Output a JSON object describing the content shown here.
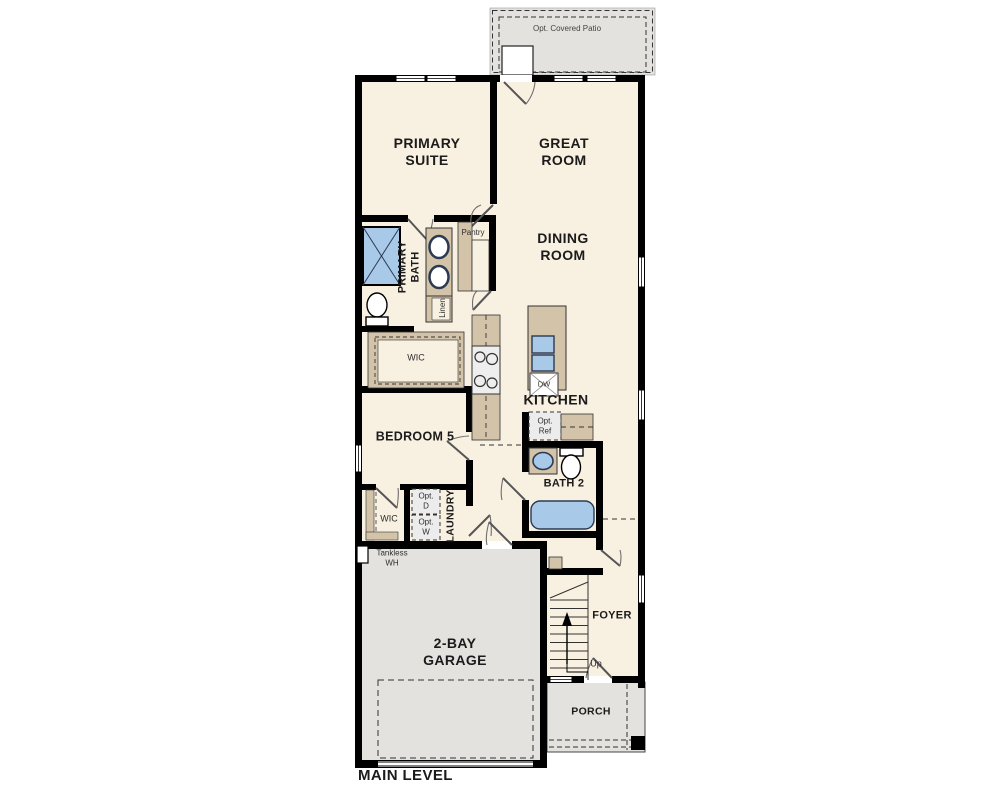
{
  "plan": {
    "title": "MAIN LEVEL",
    "labels": {
      "patio": "Opt. Covered Patio",
      "primary_suite": "PRIMARY\nSUITE",
      "great_room": "GREAT\nROOM",
      "dining_room": "DINING\nROOM",
      "primary_bath": "PRIMARY\nBATH",
      "pantry": "Pantry",
      "linen": "Linen",
      "wic_primary": "WIC",
      "kitchen": "KITCHEN",
      "dishwasher": "DW",
      "opt_ref": "Opt.\nRef",
      "bedroom5": "BEDROOM 5",
      "bath2": "BATH 2",
      "wic_secondary": "WIC",
      "opt_dryer": "Opt.\nD",
      "opt_washer": "Opt.\nW",
      "laundry": "LAUNDRY",
      "tankless_wh": "Tankless\nWH",
      "garage": "2-BAY\nGARAGE",
      "foyer": "FOYER",
      "up": "Up",
      "porch": "PORCH"
    },
    "colors": {
      "wall": "#000000",
      "room_fill": "#f8f0e1",
      "concrete_fill": "#e3e2df",
      "cabinet_tan": "#d2c3a9",
      "fixture_blue": "#a9c9e9",
      "dashed_line": "#333333"
    }
  }
}
